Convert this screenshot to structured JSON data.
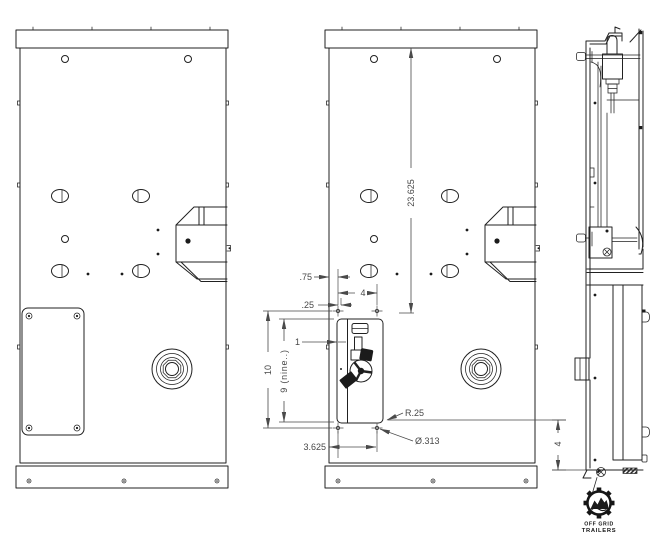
{
  "dimensions": {
    "overall_height": "23.625",
    "top_offset": ".75",
    "hole_spacing_width": "4",
    "edge_gap": ".25",
    "valve_inset": "1",
    "hole_span_height": "10",
    "cutout_height": "9 (nine..)",
    "corner_radius": "R.25",
    "hole_diameter": "Ø.313",
    "bottom_inset": "3.625",
    "side_bottom_height": "4"
  },
  "logo": {
    "line1": "OFF GRID",
    "line2": "TRAILERS"
  },
  "colors": {
    "line": "#212121",
    "dimension": "#4a4a4a",
    "background": "#ffffff"
  }
}
